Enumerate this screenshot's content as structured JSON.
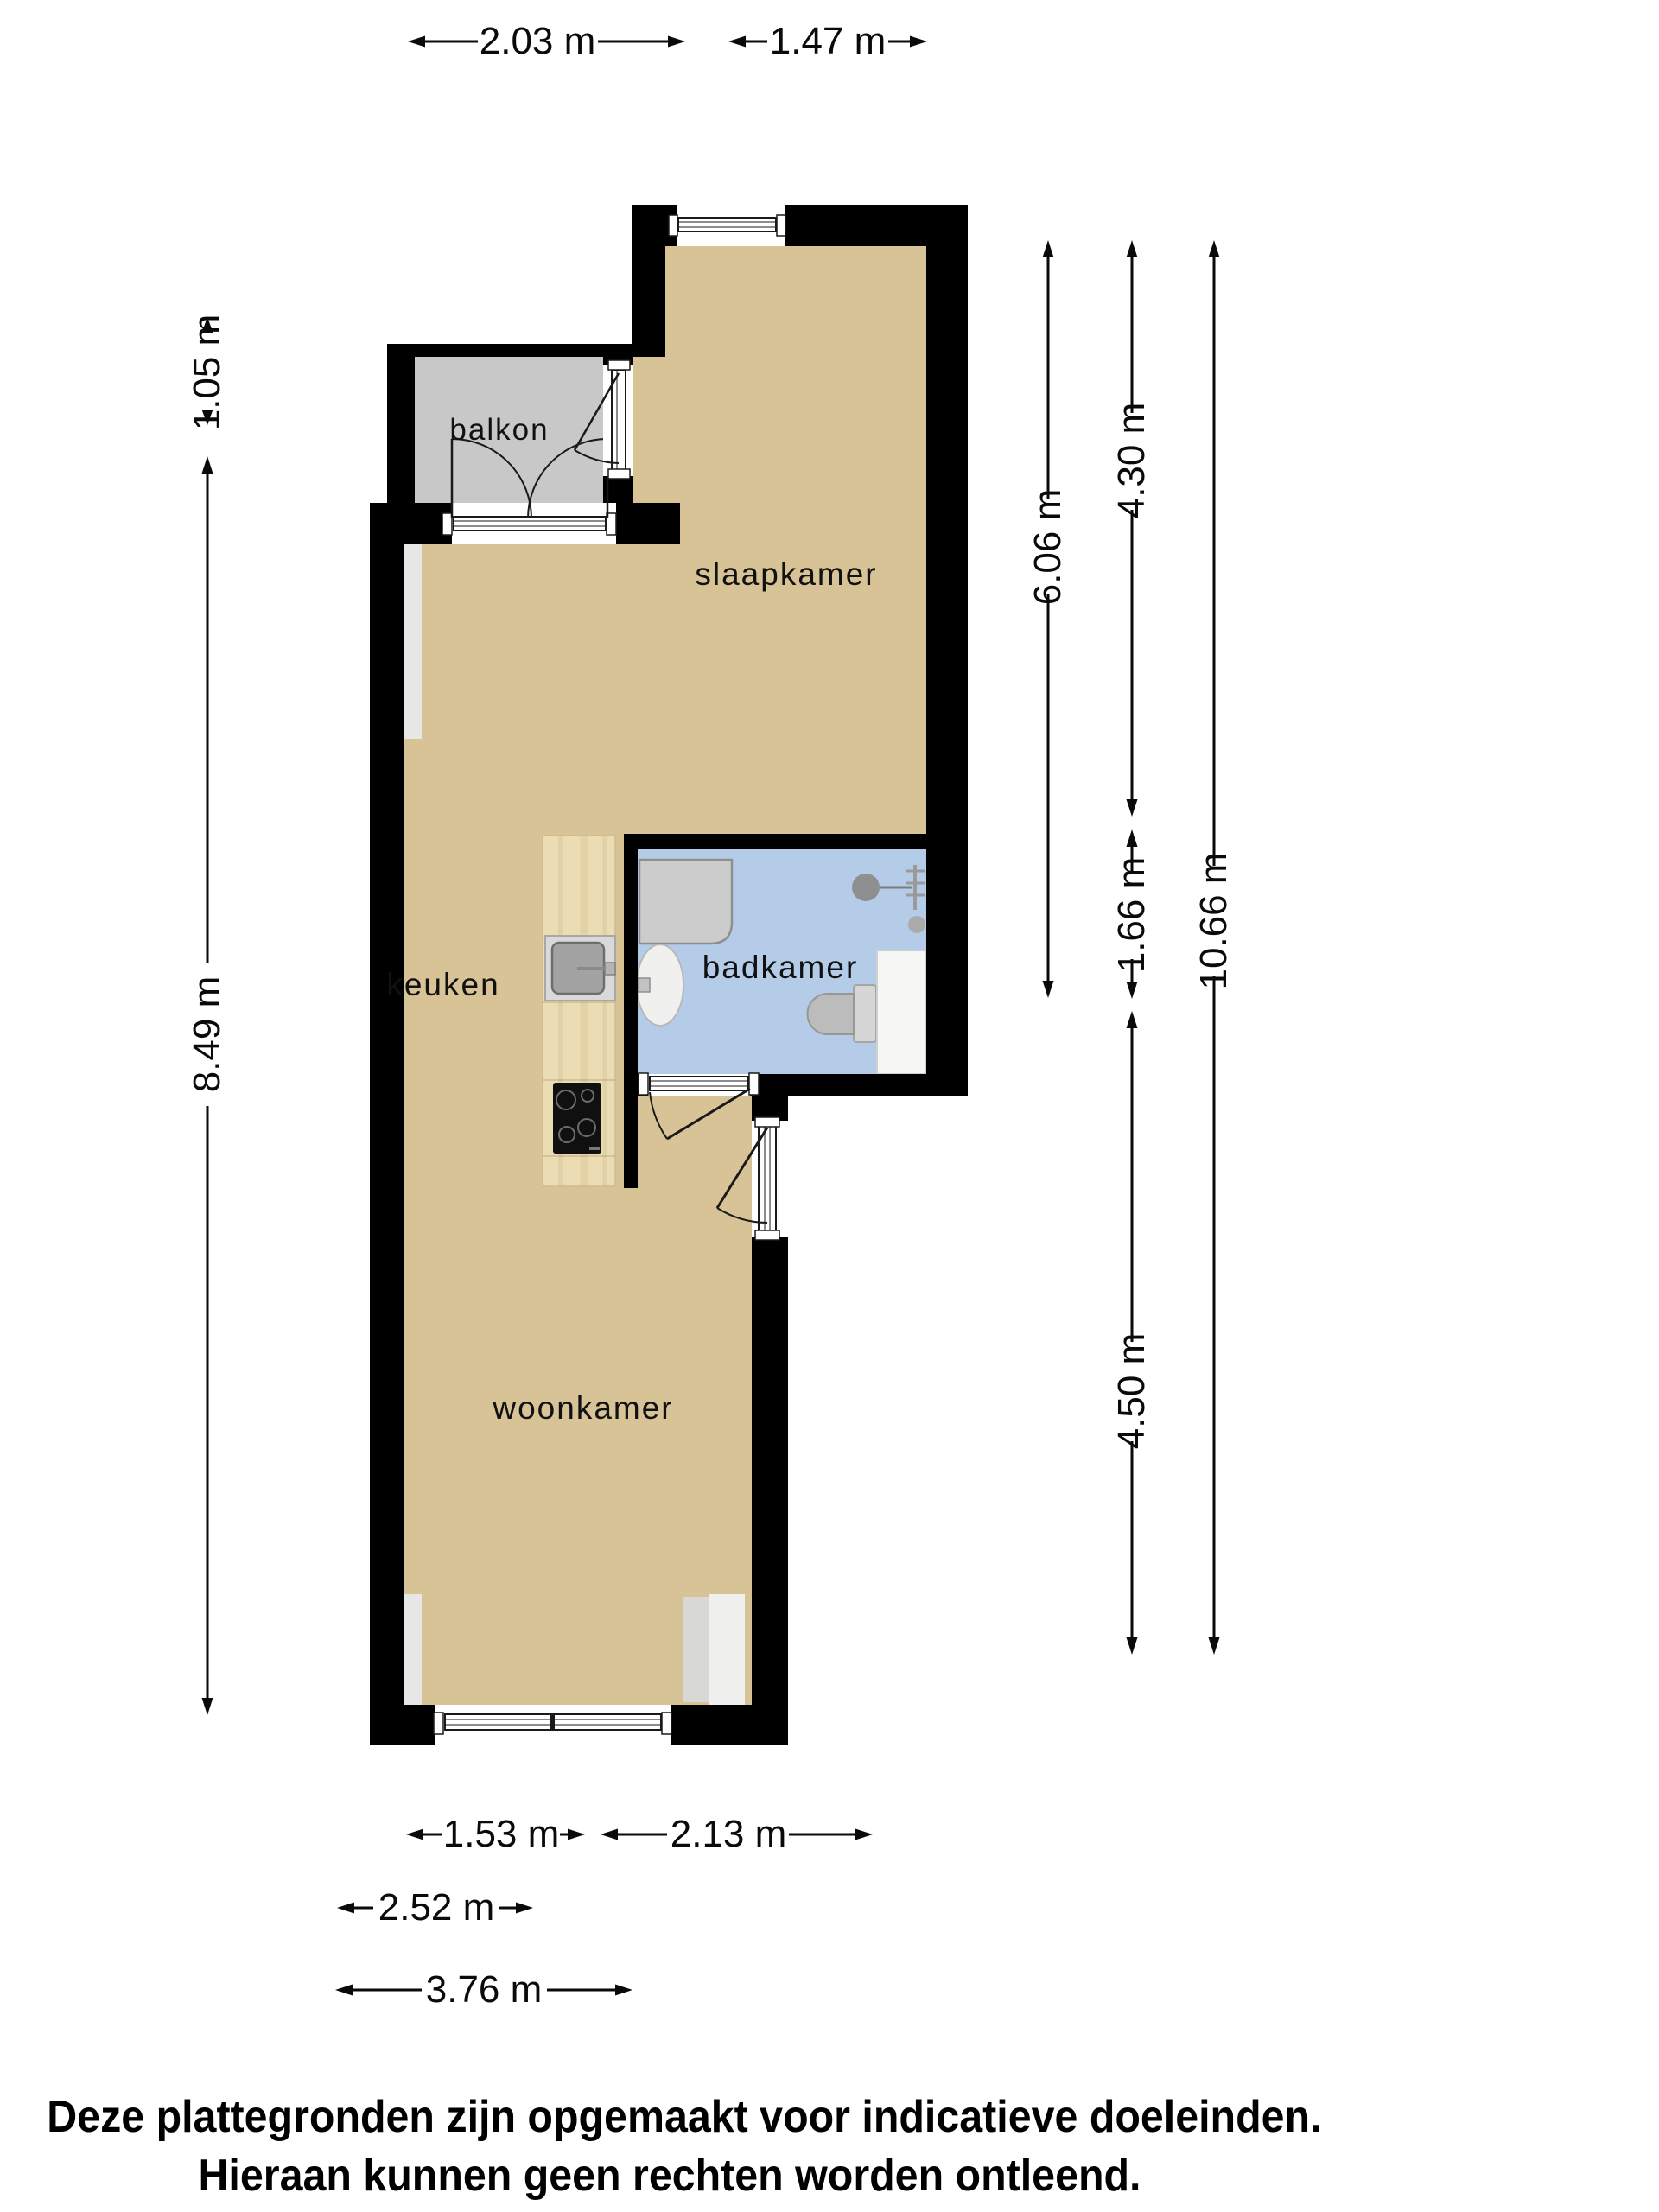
{
  "plan": {
    "rooms": {
      "balkon": {
        "label": "balkon"
      },
      "slaapkamer": {
        "label": "slaapkamer"
      },
      "keuken": {
        "label": "keuken"
      },
      "badkamer": {
        "label": "badkamer"
      },
      "woonkamer": {
        "label": "woonkamer"
      }
    },
    "dimensions": {
      "top_left": {
        "label": "2.03 m"
      },
      "top_right": {
        "label": "1.47 m"
      },
      "left_upper": {
        "label": "1.05 m"
      },
      "left_lower": {
        "label": "8.49 m"
      },
      "right_inner": {
        "label": "6.06 m"
      },
      "right_mid_upper": {
        "label": "4.30 m"
      },
      "right_mid_small": {
        "label": "1.66 m"
      },
      "right_mid_lower": {
        "label": "4.50 m"
      },
      "right_outer": {
        "label": "10.66 m"
      },
      "bottom_row1_left": {
        "label": "1.53 m"
      },
      "bottom_row1_right": {
        "label": "2.13 m"
      },
      "bottom_row2": {
        "label": "2.52 m"
      },
      "bottom_row3": {
        "label": "3.76 m"
      }
    },
    "disclaimer": {
      "line1": "Deze plattegronden zijn opgemaakt voor indicatieve doeleinden.",
      "line2": "Hieraan kunnen geen rechten worden ontleend."
    },
    "colors": {
      "wall": "#000000",
      "floor": "#d8c397",
      "balcony": "#c8c8c8",
      "bathroom": "#b5cce8",
      "counter": "#ebdcb3",
      "fixture_gray": "#cccccc",
      "fixture_white": "#f6f6f5"
    }
  }
}
